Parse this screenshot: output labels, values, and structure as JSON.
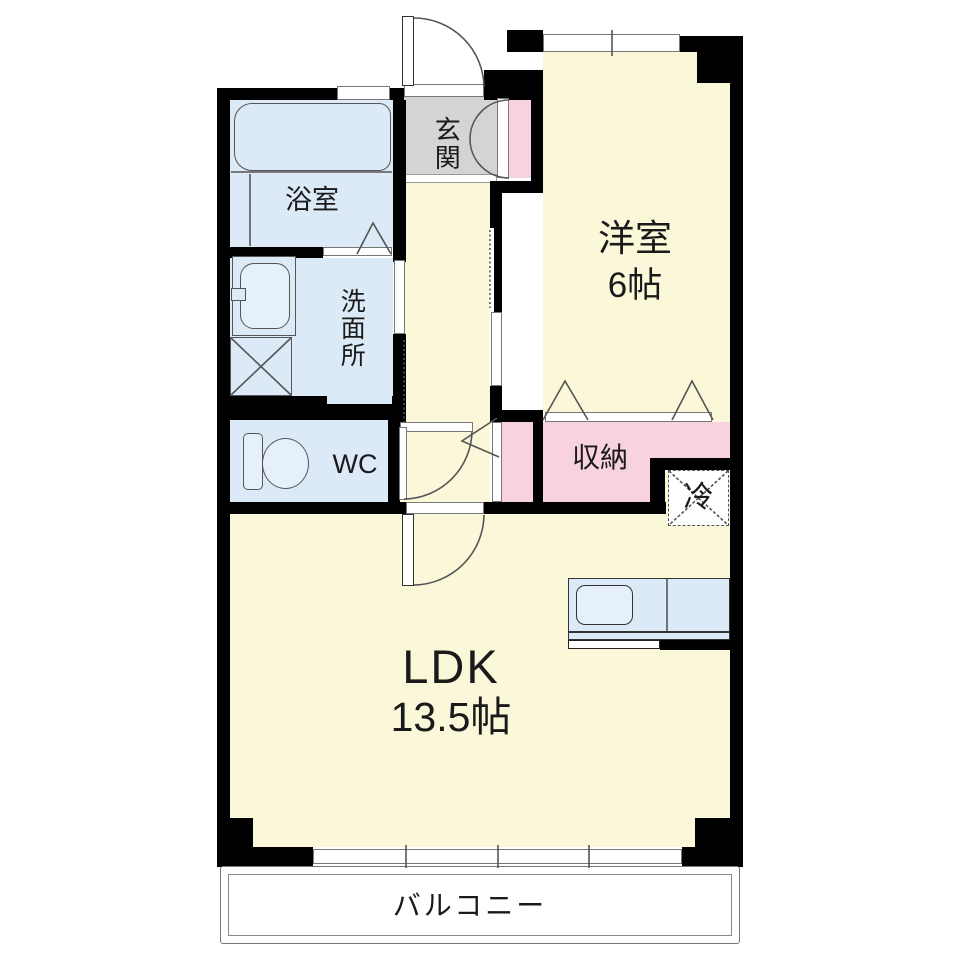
{
  "plan": {
    "type": "apartment-floor-plan-1LDK",
    "rooms": {
      "genkan": {
        "label": "玄関"
      },
      "bathroom": {
        "label": "浴室"
      },
      "washroom": {
        "label": "洗面所"
      },
      "toilet": {
        "label": "WC"
      },
      "western_room": {
        "label": "洋室",
        "size": "6帖"
      },
      "storage": {
        "label": "収納"
      },
      "refrigerator": {
        "label": "冷"
      },
      "ldk": {
        "label": "LDK",
        "size": "13.5帖"
      },
      "balcony": {
        "label": "バルコニー"
      }
    },
    "colors": {
      "room_yellow": "#FAF8D8",
      "water_blue": "#DCE9F6",
      "closet_pink": "#F8D3DF",
      "genkan_gray": "#D4D4D4",
      "wall_black": "#000000",
      "line_gray": "#555555"
    }
  }
}
